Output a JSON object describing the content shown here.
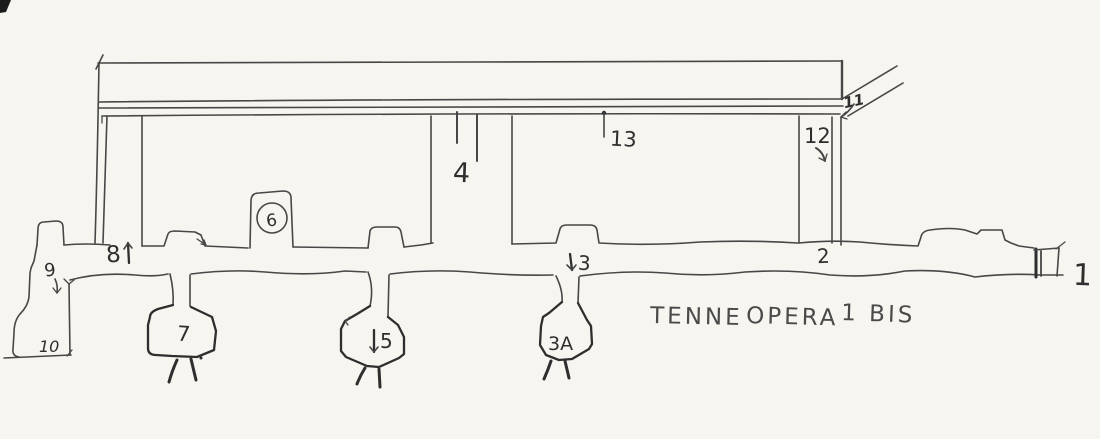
{
  "title": {
    "words": [
      "TENNE",
      "OPERA",
      "1 BIS"
    ]
  },
  "labels": {
    "l1": "1",
    "l2": "2",
    "l3": "3",
    "l3a": "3A",
    "l4": "4",
    "l5": "5",
    "l6": "6",
    "l7": "7",
    "l8": "8",
    "l9": "9",
    "l10": "10",
    "l11": "11",
    "l12": "12",
    "l13": "13"
  },
  "colors": {
    "paper": "#f7f5f0",
    "ink": "#474747",
    "ink-dark": "#2e2e2e"
  }
}
